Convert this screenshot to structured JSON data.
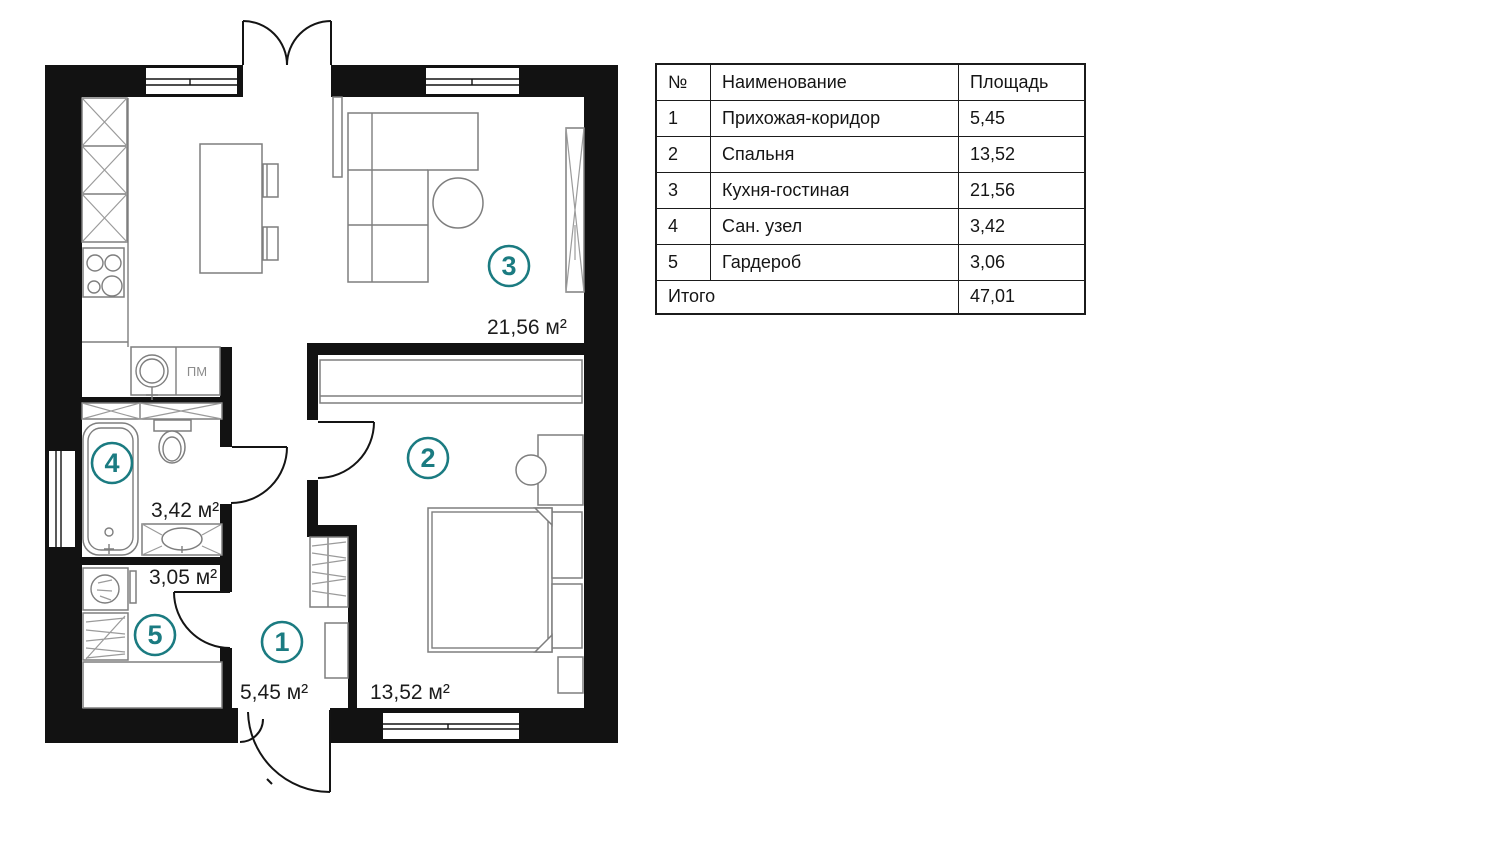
{
  "colors": {
    "accent": "#1b7b81",
    "wall": "#121212"
  },
  "plan": {
    "badges": [
      {
        "num": "1"
      },
      {
        "num": "2"
      },
      {
        "num": "3"
      },
      {
        "num": "4"
      },
      {
        "num": "5"
      }
    ],
    "areas": {
      "hallway": "5,45 м²",
      "bedroom": "13,52 м²",
      "kitchen": "21,56 м²",
      "bathroom": "3,42 м²",
      "wardrobe": "3,05 м²"
    },
    "labels": {
      "dishwasher": "ПМ"
    }
  },
  "table": {
    "headers": {
      "num": "№",
      "name": "Наименование",
      "area": "Площадь"
    },
    "rows": [
      {
        "num": "1",
        "name": "Прихожая-коридор",
        "area": "5,45"
      },
      {
        "num": "2",
        "name": "Спальня",
        "area": "13,52"
      },
      {
        "num": "3",
        "name": "Кухня-гостиная",
        "area": "21,56"
      },
      {
        "num": "4",
        "name": "Сан. узел",
        "area": "3,42"
      },
      {
        "num": "5",
        "name": "Гардероб",
        "area": "3,06"
      }
    ],
    "total": {
      "label": "Итого",
      "value": "47,01"
    }
  }
}
